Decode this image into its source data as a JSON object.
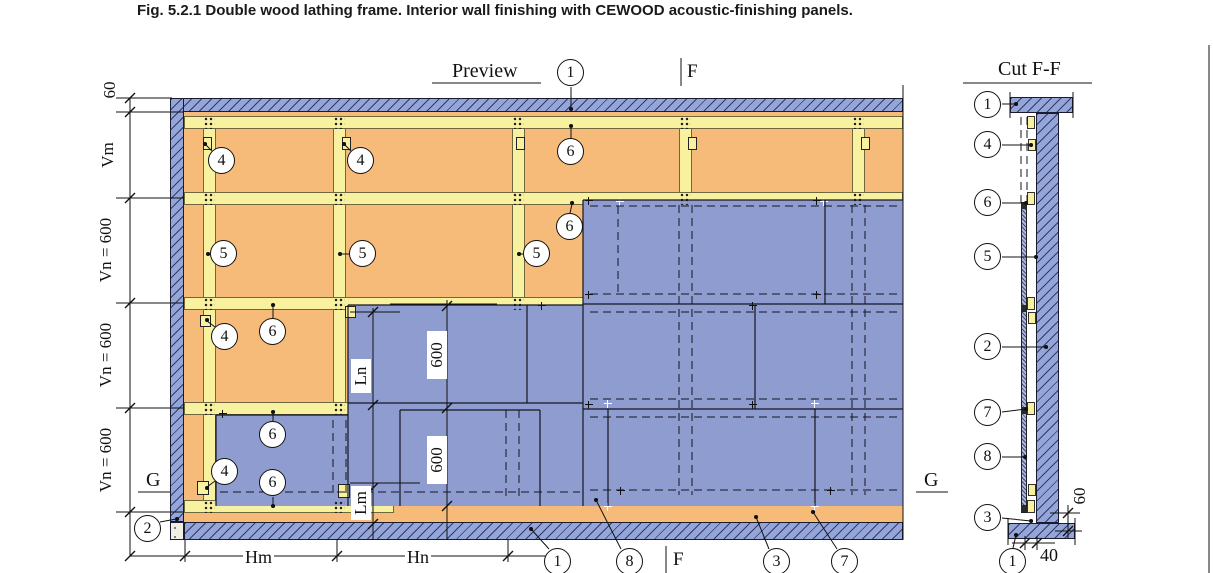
{
  "figure_title": "Fig. 5.2.1  Double wood lathing frame. Interior wall finishing with CEWOOD acoustic-finishing panels.",
  "views": {
    "preview_label": "Preview",
    "cut_label": "Cut F-F"
  },
  "markers": {
    "f": "F",
    "g": "G"
  },
  "balloon_numbers": {
    "n1": "1",
    "n2": "2",
    "n3": "3",
    "n4": "4",
    "n5": "5",
    "n6": "6",
    "n7": "7",
    "n8": "8"
  },
  "dimensions": {
    "d60": "60",
    "vm": "Vm",
    "vn600": "Vn = 600",
    "hm": "Hm",
    "hn": "Hn",
    "ln": "Ln",
    "lm": "Lm",
    "d600": "600",
    "d40": "40"
  },
  "colors": {
    "hatch_blue": "#93a5d9",
    "panel_blue": "#8e9cd0",
    "frame_orange": "#f6ba79",
    "batten_yellow": "#f8f2a0",
    "line": "#111111"
  }
}
